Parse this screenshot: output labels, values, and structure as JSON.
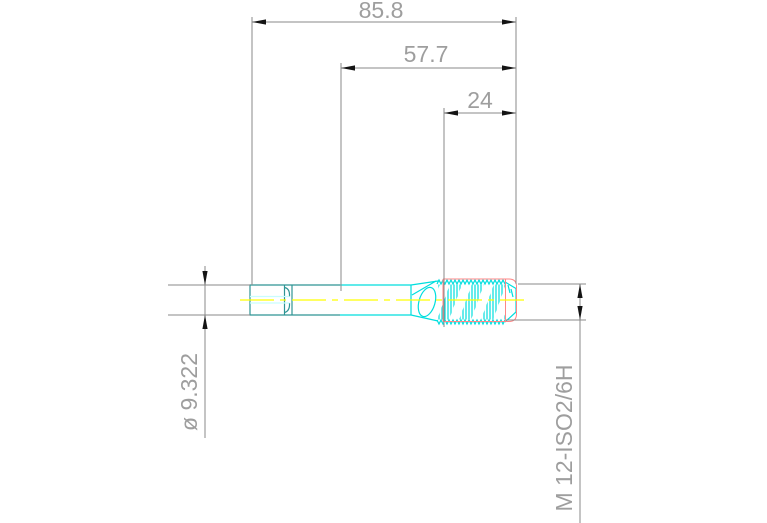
{
  "drawing": {
    "title": "tap-technical-drawing",
    "view": "side-profile",
    "dims": {
      "overall": {
        "label": "85.8",
        "orientation": "horizontal",
        "measures": "overall length"
      },
      "front": {
        "label": "57.7",
        "orientation": "horizontal",
        "measures": "length from square end to tip section"
      },
      "thread": {
        "label": "24",
        "orientation": "horizontal",
        "measures": "thread length"
      },
      "diameter": {
        "label": "ø 9.322",
        "orientation": "vertical-rotated",
        "measures": "shank diameter"
      },
      "spec": {
        "label": "M 12-ISO2/6H",
        "orientation": "vertical-rotated",
        "measures": "thread designation"
      }
    },
    "colors": {
      "background": "#ffffff",
      "dimension_line": "#8a8a8a",
      "dimension_text": "#9e9e9e",
      "arrowhead": "#141414",
      "part_rear_section": "#2e9494",
      "part_front_section": "#00dede",
      "square_flat_highlight": "#c9fdfd",
      "thread_major_outline": "#ff8585",
      "centerline": "#ffff00"
    }
  }
}
